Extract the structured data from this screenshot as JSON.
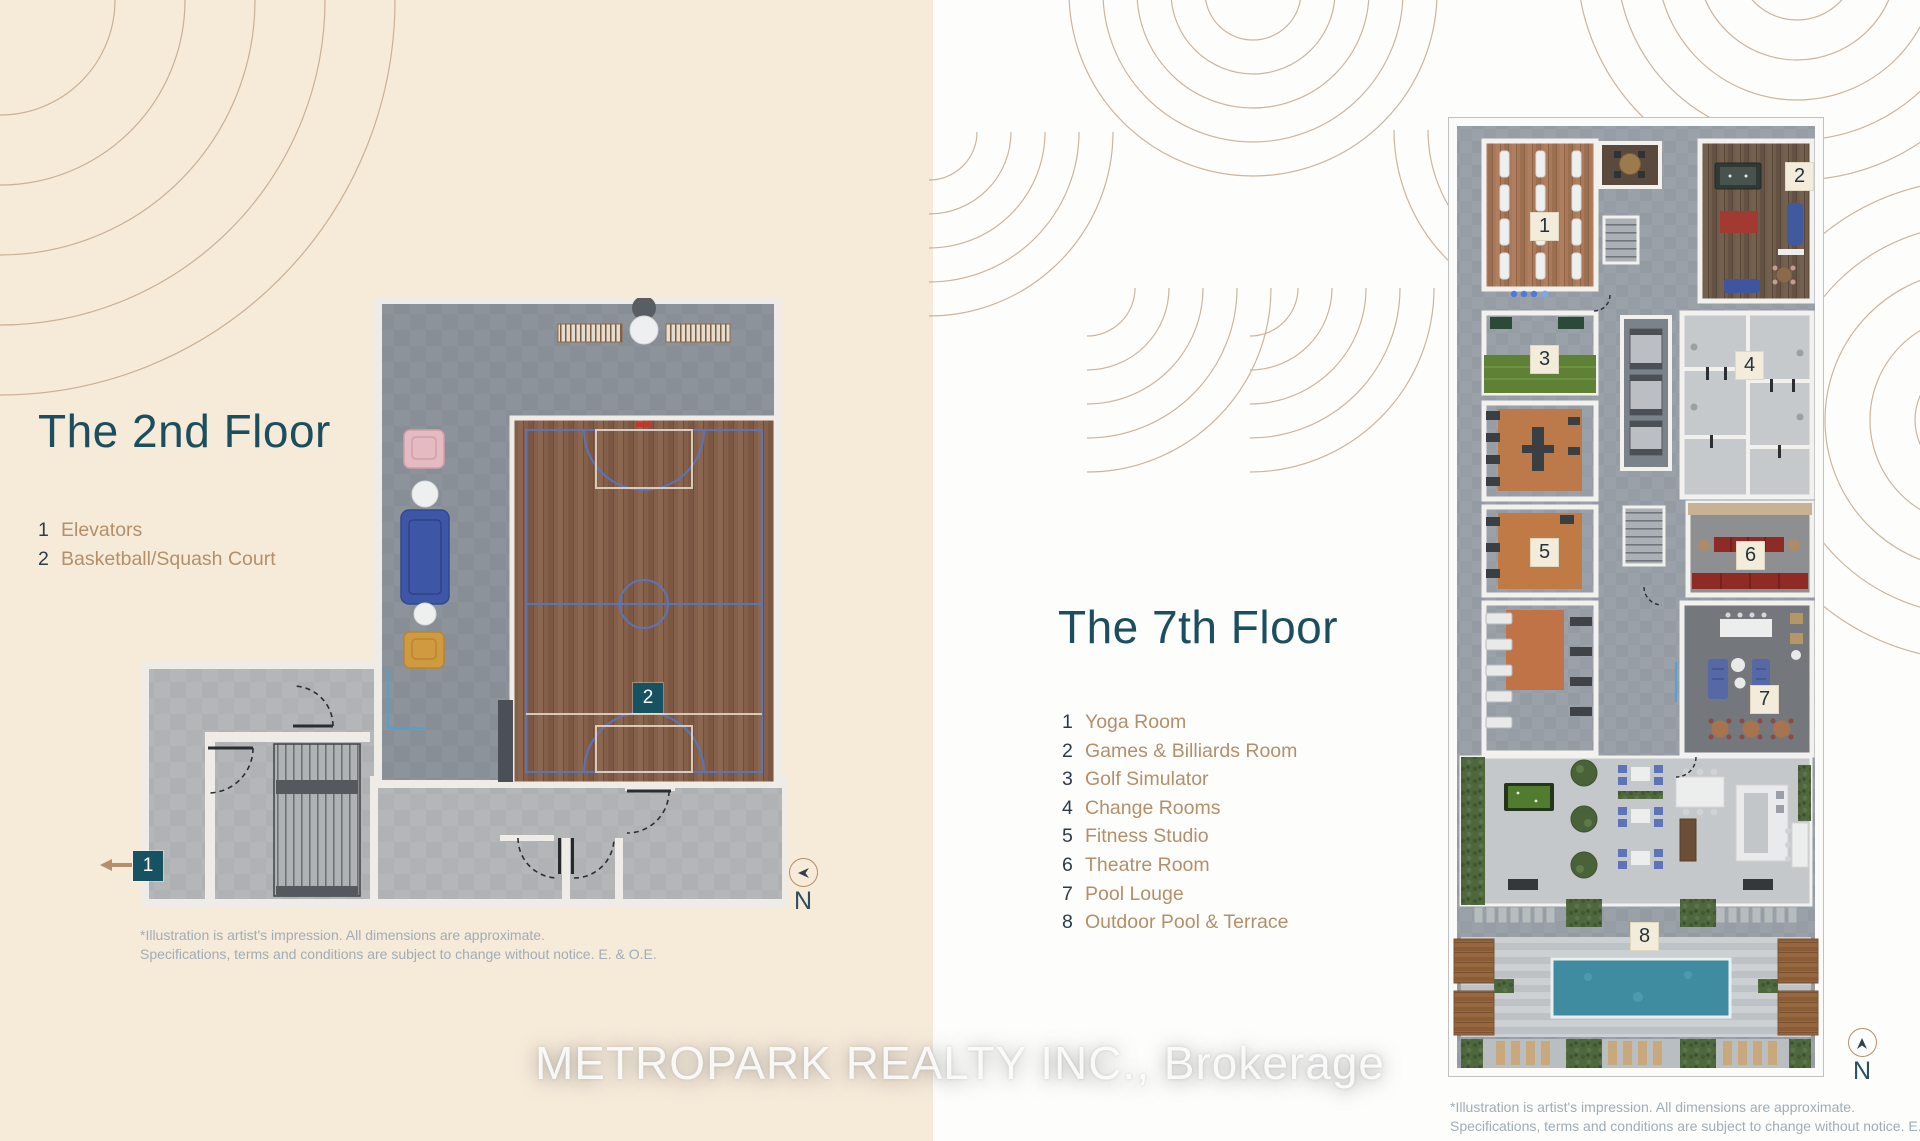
{
  "left_panel": {
    "title": "The 2nd Floor",
    "legend": [
      {
        "num": "1",
        "label": "Elevators"
      },
      {
        "num": "2",
        "label": "Basketball/Squash Court"
      }
    ],
    "markers": [
      "1",
      "2"
    ],
    "north_label": "N",
    "disclaimer": {
      "line1": "*Illustration is artist's impression. All dimensions are approximate.",
      "line2": "Specifications, terms and conditions are subject to change without notice. E. & O.E."
    }
  },
  "right_panel": {
    "title": "The 7th Floor",
    "legend": [
      {
        "num": "1",
        "label": "Yoga Room"
      },
      {
        "num": "2",
        "label": "Games & Billiards Room"
      },
      {
        "num": "3",
        "label": "Golf Simulator"
      },
      {
        "num": "4",
        "label": "Change Rooms"
      },
      {
        "num": "5",
        "label": "Fitness Studio"
      },
      {
        "num": "6",
        "label": "Theatre Room"
      },
      {
        "num": "7",
        "label": "Pool Louge"
      },
      {
        "num": "8",
        "label": "Outdoor Pool & Terrace"
      }
    ],
    "markers": [
      "1",
      "2",
      "3",
      "4",
      "5",
      "6",
      "7",
      "8"
    ],
    "north_label": "N",
    "disclaimer": {
      "line1": "*Illustration is artist's impression. All dimensions are approximate.",
      "line2": "Specifications, terms and conditions are subject to change without notice. E. & O.E."
    }
  },
  "watermark": "METROPARK REALTY INC., Brokerage",
  "colors": {
    "left_background": "#f6ead9",
    "right_background": "#fdfdfc",
    "title_teal": "#1b4e5e",
    "legend_tan": "#b3906a",
    "marker_teal": "#175262",
    "marker_beige": "#f4ecda",
    "deco_arc_tan": "#bb9e7e",
    "disclaimer_gray": "#9fadb6",
    "pool_teal": "#3f8ba0",
    "court_wood": "#84604a",
    "court_line_blue": "#5377c9"
  }
}
